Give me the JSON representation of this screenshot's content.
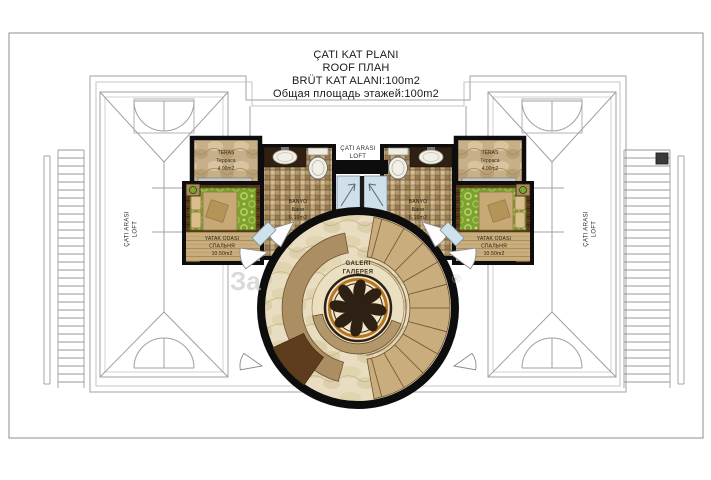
{
  "title": {
    "l1": "ÇATI KAT PLANI",
    "l2": "ROOF ПЛАН",
    "l3": "BRÜT KAT ALANI:100m2",
    "l4": "Общая площадь этажей:100m2"
  },
  "loft_top": {
    "l1": "ÇATI ARASI",
    "l2": "LOFT"
  },
  "loft_left": {
    "l1": "ÇATI ARASI",
    "l2": "LOFT"
  },
  "loft_right": {
    "l1": "ÇATI ARASI",
    "l2": "LOFT"
  },
  "gallery": {
    "l1": "GALERI",
    "l2": "ГАЛЕРЕЯ"
  },
  "rooms": {
    "teras_left": {
      "name": "TERAS",
      "ru": "Терраса",
      "area": "4.00m2"
    },
    "teras_right": {
      "name": "TERAS",
      "ru": "Терраса",
      "area": "4.00m2"
    },
    "banyo_left": {
      "name": "BANYO",
      "ru": "Баня",
      "area": "6.10m2"
    },
    "banyo_right": {
      "name": "BANYO",
      "ru": "Баня",
      "area": "6.10m2"
    },
    "bed_left": {
      "name": "YATAK ODASI",
      "ru": "СПАЛЬНЯ",
      "area": "10.50m2"
    },
    "bed_right": {
      "name": "YATAK ODASI",
      "ru": "СПАЛЬНЯ",
      "area": "10.50m2"
    }
  },
  "watermark": {
    "frag1": "За",
    "frag2": "®"
  },
  "colors": {
    "wall": "#0d0d0d",
    "roof_line": "#a0a0a0",
    "wood_dark": "#57361b",
    "wood_light": "#c9ae7d",
    "tile_beige": "#c4a878",
    "rug_green": "#7fa12f",
    "marble_cream": "#e8ddc0",
    "band_tan": "#ab8f63",
    "medallion_gold": "#b5761f",
    "ornament_brown": "#2e2114",
    "glass_blue": "#cfe0ea"
  }
}
